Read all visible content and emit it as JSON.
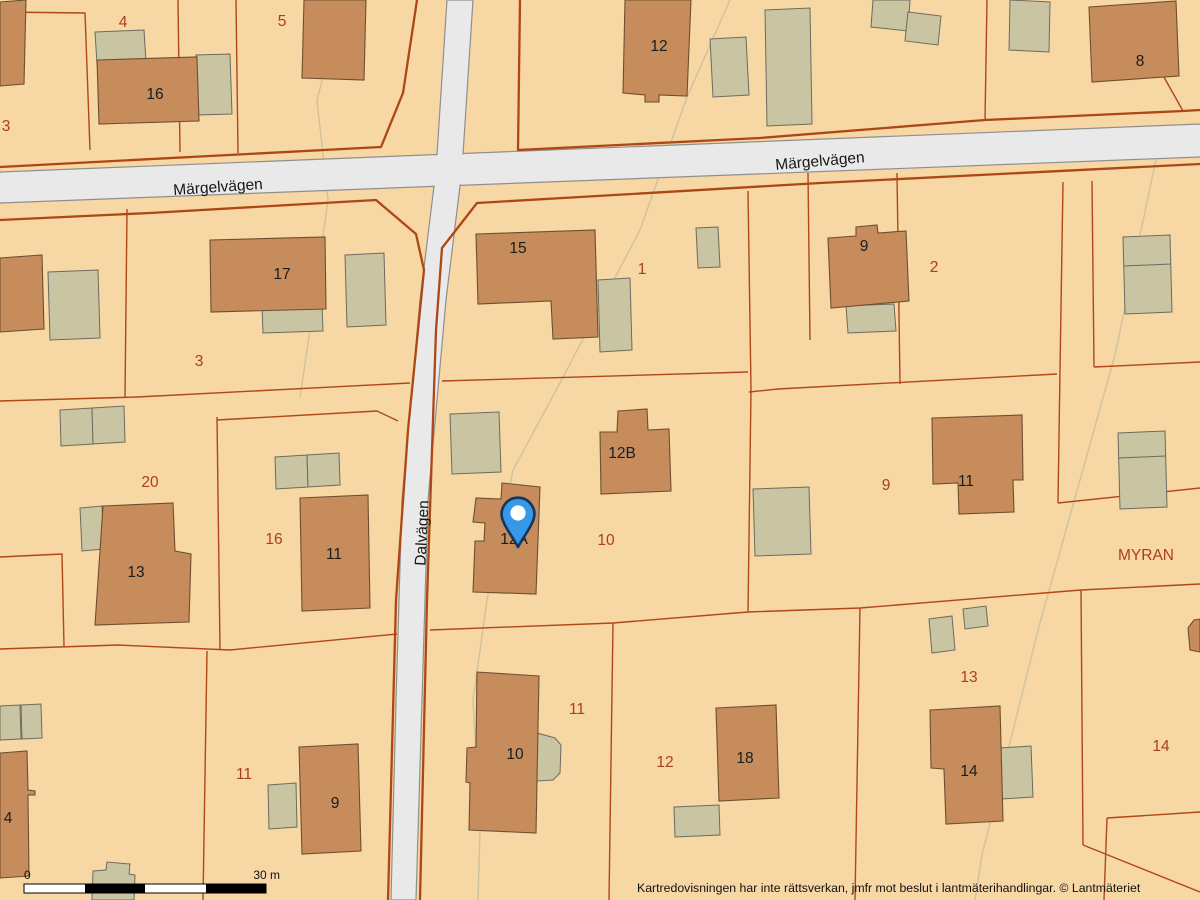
{
  "streets": [
    {
      "name": "Märgelvägen"
    },
    {
      "name": "Märgelvägen"
    },
    {
      "name": "Dalvägen"
    }
  ],
  "place_label": "MYRAN",
  "parcel_labels": [
    "3",
    "4",
    "5",
    "1",
    "2",
    "3",
    "20",
    "16",
    "9",
    "10",
    "11",
    "11",
    "12",
    "13",
    "14"
  ],
  "building_labels": [
    "16",
    "12",
    "8",
    "17",
    "15",
    "9",
    "12B",
    "12A",
    "11",
    "13",
    "11",
    "10",
    "18",
    "14",
    "9",
    "4"
  ],
  "marker": {
    "type": "location-pin",
    "fill": "#3898e8",
    "outline": "#14365c",
    "inner": "#ffffff"
  },
  "scale_bar": {
    "start_label": "0",
    "end_label": "30 m"
  },
  "attribution": "Kartredovisningen har inte rättsverkan, jmfr mot beslut i lantmäterihandlingar. © Lantmäteriet",
  "colors": {
    "background": "#f7d7a4",
    "road_fill": "#e9e9e9",
    "road_casing": "#8f8f8f",
    "parcel_boundary": "#b0481a",
    "building_fill": "#c68c5c",
    "building_stroke": "#6e4f2d",
    "outbuilding_fill": "#c9c5a2",
    "parcel_text": "#ab3f1c",
    "building_text": "#1c1c1c",
    "marker_blue": "#3898e8"
  }
}
